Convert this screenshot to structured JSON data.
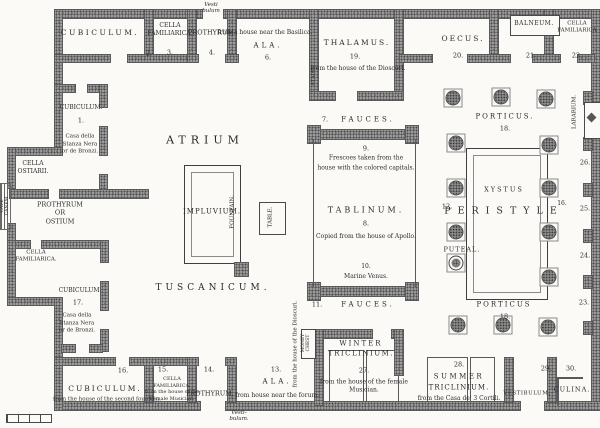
{
  "labels": {
    "atrium": "ATRIUM",
    "tuscanicum": "TUSCANICUM.",
    "impluvium": "IMPLUVIUM.",
    "fountain": "FOUNTAIN.",
    "table": "TABLE.",
    "cubiculum2": "CUBICULUM.",
    "cella3": "CELLA\nFAMILIARICA.",
    "prothyrum4": "PROTHYRUM",
    "vestibulum_top": "Vesti\nbulum",
    "ala6_cap": "from a house near the Basilica.",
    "ala6": "ALA.",
    "stairs": "STAIRS.",
    "thalamus": "THALAMUS.",
    "thalamus_cap": "from the house of the Dioscuri.",
    "oecus": "OECUS.",
    "balneum": "BALNEUM.",
    "cella22": "CELLA\nFAMILIARICA",
    "fauces7": "FAUCES.",
    "porticus_top": "PORTICUS.",
    "tablinum_cap9": "Frescoes taken from the\nhouse with the colored capitals.",
    "tablinum": "TABLINUM.",
    "tablinum_cap8": "Copied from the house of Apollo.",
    "marine_venus": "Marine Venus.",
    "xystus": "XYSTUS",
    "peristyle": "PERISTYLE",
    "puteal": "PUTEAL.",
    "lararium": "LARARIUM.",
    "porticus_bottom": "PORTICUS",
    "fauces11": "FAUCES.",
    "winter1": "WINTER",
    "winter2": "TRICLINIUM.",
    "winter_cap": "from the house of the female\nMusician.",
    "money_chest": "MONEY\nCHEST",
    "money_cap": "from the house of the Dioscuri.",
    "summer1": "SUMMER",
    "summer2": "TRICLINIUM.",
    "summer_cap": "from the Casa de' 3 Cortili.",
    "vestibulum_br": "VESTIBULUM.",
    "culina": "CULINA.",
    "cubiculum16": "CUBICULUM.",
    "cub16_cap": "from the house of the second fountain.",
    "cella15": "CELLA\nFAMILIARICA.\nfrom the house of the\nFemale Musician.",
    "prothyrum14": "PROTHYRUM.",
    "vestibulum_bottom": "Vesti-\nbulum.",
    "ala13": "ALA.",
    "ala13_cap": "from house near the forum.",
    "cubiculum1": "CUBICULUM.",
    "cub1_cap": "Casa della\nStanza Nera\nor de Bronzi.",
    "cella_ostiarii": "CELLA\nOSTIARII.",
    "prothyrum_ostium": "PROTHYRUM\nOR\nOSTIUM",
    "cave_canem": "CAVE\nCANEM",
    "cella_left": "CELLA\nFAMILIARICA.",
    "cubiculum17": "CUBICULUM.",
    "cub17_cap": "Casa della\nStanza Nera\nor de Bronzi."
  },
  "numbers": {
    "r1": "1.",
    "r2": "2.",
    "r3": "3.",
    "r4": "4.",
    "r6": "6.",
    "r7": "7.",
    "r8": "8.",
    "r9": "9.",
    "r10": "10.",
    "r11": "11.",
    "r12": "12.",
    "r13": "13.",
    "r14": "14.",
    "r15": "15.",
    "r16": "16.",
    "r16b": "16.",
    "r17": "17.",
    "r18a": "18.",
    "r18b": "18.",
    "r19": "19.",
    "r20": "20.",
    "r21": "21.",
    "r22": "22.",
    "r23": "23.",
    "r24": "24.",
    "r25": "25.",
    "r26": "26.",
    "r27": "27.",
    "r28": "28.",
    "r29": "29.",
    "r30": "30."
  },
  "colors": {
    "ink": "#2b2b2b",
    "wall": "#9a9a9a",
    "paper": "#fbfaf6"
  }
}
